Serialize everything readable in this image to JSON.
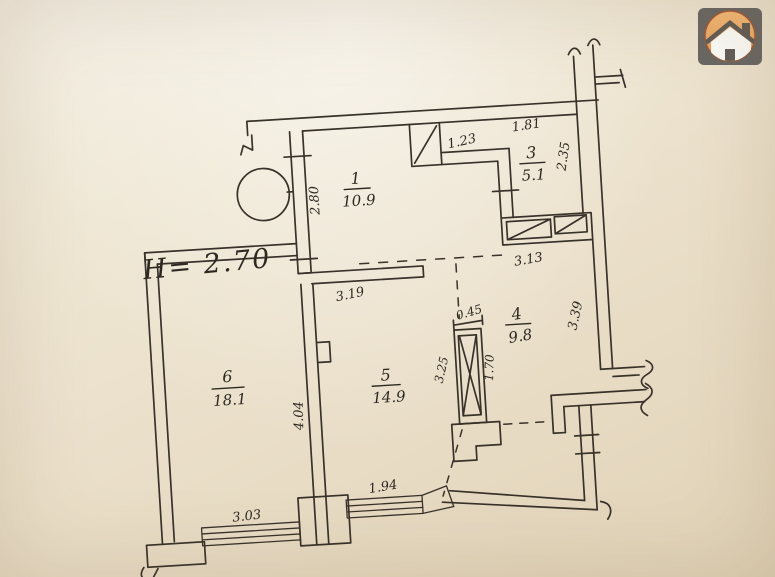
{
  "document": {
    "type_label": "apartment floor plan (scanned hand drawing)",
    "ceiling_height": "H= 2.70",
    "paper_color": "#eadfc9",
    "ink_color": "#39322a"
  },
  "rooms": [
    {
      "number": "1",
      "area": "10.9"
    },
    {
      "number": "3",
      "area": "5.1"
    },
    {
      "number": "4",
      "area": "9.8"
    },
    {
      "number": "5",
      "area": "14.9"
    },
    {
      "number": "6",
      "area": "18.1"
    }
  ],
  "dimensions": {
    "room1_left": "2.80",
    "vent_width": "1.23",
    "room3_top": "1.81",
    "room3_side": "2.35",
    "room3_bottom": "3.13",
    "hall_stub": "3.19",
    "shaft_width": "0.45",
    "shaft_height": "1.70",
    "loggia_left": "3.25",
    "loggia_right": "3.39",
    "room6_right": "4.04",
    "window_left": "3.03",
    "window_right": "1.94"
  },
  "logo": {
    "icon": "house-icon",
    "square_color": "#605e5c",
    "circle_color": "#eea45b"
  }
}
